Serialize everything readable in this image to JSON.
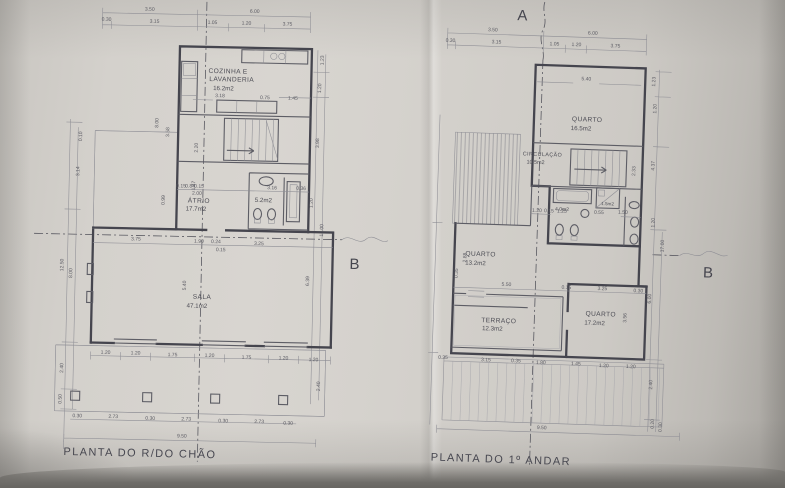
{
  "colors": {
    "paper": "#d5d2cd",
    "ink": "#45454e",
    "shadow": "#6f6d69"
  },
  "gf": {
    "title": "PLANTA DO R/DO CHÃO",
    "marker_b": "B",
    "rooms": {
      "cozinha1": "COZINHA E",
      "cozinha2": "LAVANDERIA",
      "cozinha_area": "16.2m2",
      "atrio": "ÁTRIO",
      "atrio_area": "17.7m2",
      "wc_area": "5.2m2",
      "sala": "SALA",
      "sala_area": "47.1m2"
    },
    "dims": {
      "top1": [
        "3.50",
        "6.00"
      ],
      "top2": [
        "0.30",
        "3.15",
        "1.05",
        "1.20",
        "3.75"
      ],
      "kitchen": [
        "3.18",
        "0.75",
        "1.45"
      ],
      "wc": [
        "0.15",
        "0.84",
        "0.15",
        "3.16",
        "0.36",
        "2.00"
      ],
      "mid": [
        "3.75",
        "1.90",
        "0.24",
        "3.25",
        "0.15"
      ],
      "sala_h": "5.40",
      "bottom1": [
        "1.20",
        "1.20",
        "1.75",
        "1.20",
        "1.75",
        "1.20",
        "1.20"
      ],
      "bottom2": [
        "0.30",
        "2.73",
        "0.30",
        "2.73",
        "0.30",
        "2.73",
        "0.30"
      ],
      "total": "9.50",
      "left": [
        "0.10",
        "3.14",
        "12.50",
        "8.00",
        "2.40",
        "0.50"
      ],
      "left_inner": [
        "8.00",
        "3.58",
        "2.20",
        "0.99",
        "1.47"
      ],
      "right": [
        "1.23",
        "1.20",
        "3.98",
        "1.20",
        "17.00",
        "6.39",
        "2.40"
      ]
    }
  },
  "ff": {
    "title": "PLANTA DO 1º ANDAR",
    "marker_a": "A",
    "marker_b": "B",
    "rooms": {
      "quarto1": "QUARTO",
      "quarto1_area": "16.5m2",
      "circ": "CIRCULAÇÃO",
      "circ_area": "10.5m2",
      "wc_area": "4.0m2",
      "shower_area": "1.5m2",
      "quarto2": "QUARTO",
      "quarto2_area": "13.2m2",
      "terraco": "TERRAÇO",
      "terraco_area": "12.3m2",
      "quarto3": "QUARTO",
      "quarto3_area": "17.2m2"
    },
    "dims": {
      "top1": [
        "3.50",
        "6.00"
      ],
      "top2": [
        "0.30",
        "3.15",
        "1.05",
        "1.20",
        "3.75"
      ],
      "quarto_w": "5.40",
      "bath": [
        "1.20",
        "0.15",
        "1.25",
        "0.55",
        "1.50"
      ],
      "stair_h": "2.33",
      "mid": [
        "5.50",
        "0.15",
        "3.25",
        "0.30"
      ],
      "left_inner": [
        "2.88",
        "0.35"
      ],
      "quarto3_h": "3.56",
      "bottom1": [
        "0.35",
        "3.15",
        "0.35",
        "1.80",
        "1.45",
        "1.20",
        "1.20"
      ],
      "total": "9.50",
      "right": [
        "1.23",
        "1.20",
        "4.37",
        "1.20",
        "17.00",
        "6.00",
        "2.40",
        "0.20",
        "0.30"
      ]
    }
  }
}
